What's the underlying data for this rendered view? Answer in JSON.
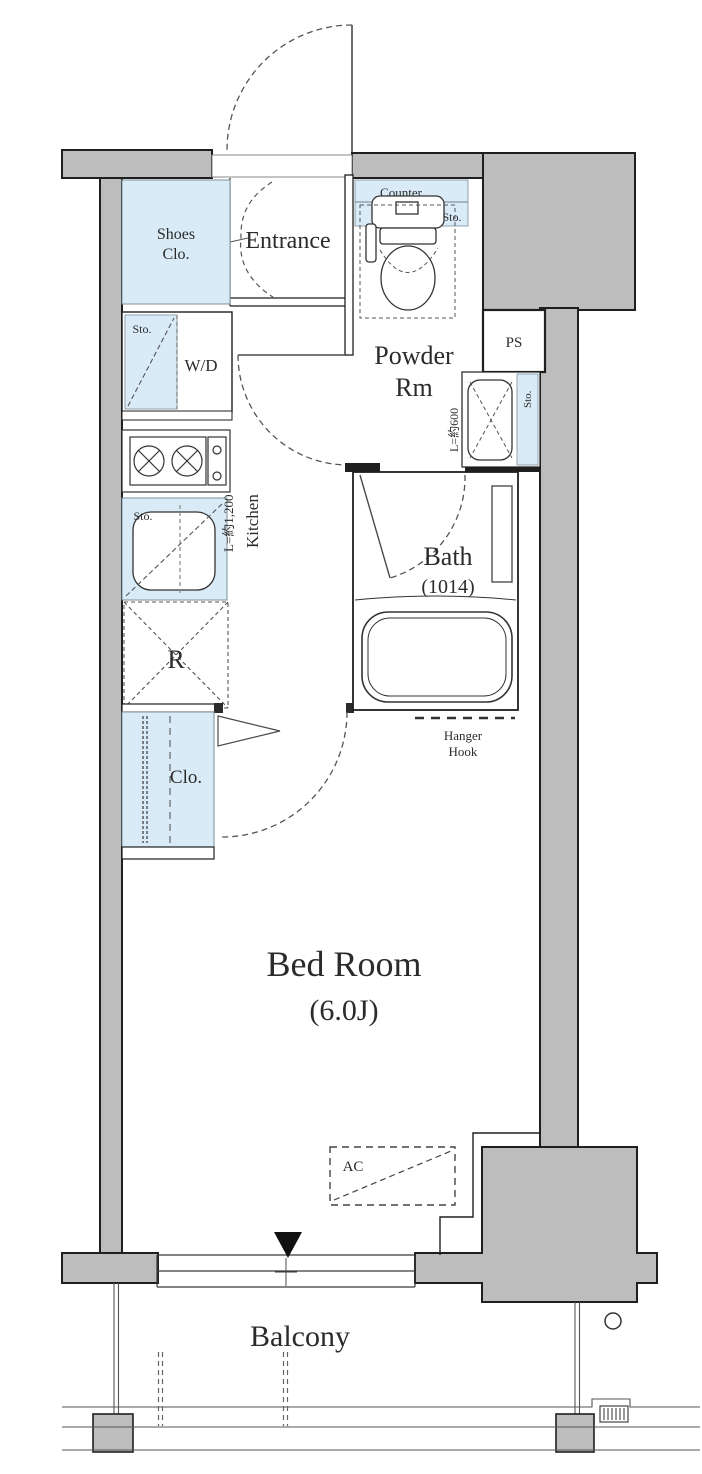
{
  "plan": {
    "rooms": {
      "entrance": "Entrance",
      "shoes_closet_line1": "Shoes",
      "shoes_closet_line2": "Clo.",
      "powder_line1": "Powder",
      "powder_line2": "Rm",
      "bath": "Bath",
      "bath_size": "(1014)",
      "bedroom": "Bed Room",
      "bedroom_size": "(6.0J)",
      "balcony": "Balcony",
      "kitchen": "Kitchen",
      "kitchen_length": "L=約1,200",
      "closet": "Clo.",
      "refrigerator": "R"
    },
    "labels": {
      "counter": "Counter",
      "storage": "Sto.",
      "washer_dryer": "W/D",
      "pipe_space": "PS",
      "vanity_length": "L=約600",
      "air_conditioner": "AC",
      "hanger_line1": "Hanger",
      "hanger_line2": "Hook"
    },
    "colors": {
      "wall_gray": "#bdbdbd",
      "storage_blue": "#d9ebf7",
      "line_dark": "#1f1f1f"
    }
  }
}
